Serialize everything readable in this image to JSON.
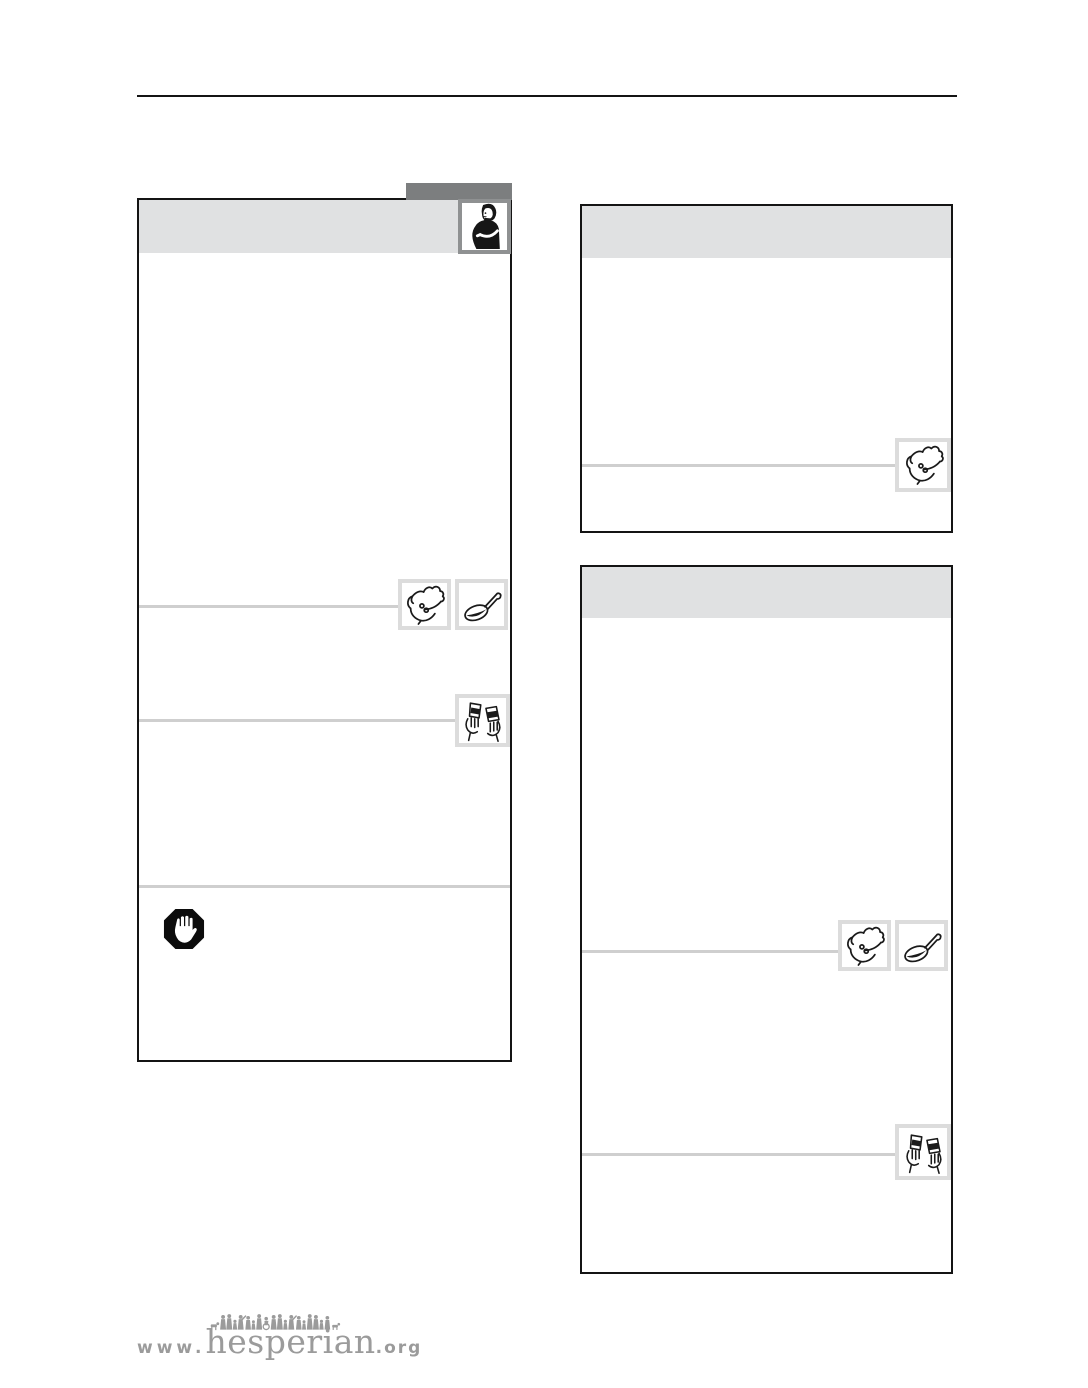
{
  "colors": {
    "ink": "#141414",
    "card_border": "#141414",
    "header_band": "#e0e1e2",
    "tab_gray": "#7c7e7f",
    "portrait_border": "#8f9192",
    "icon_frame": "#dcdcdc",
    "divider": "#cfcfcf",
    "logo_gray": "#9b9b9b",
    "paper": "#ffffff"
  },
  "footer": {
    "www": "www.",
    "name": "hesperian",
    "tld": ".org"
  },
  "icons": {
    "pregnant-woman-icon": "line drawing of a pregnant woman in dark top, hand on belly",
    "hand-with-pills-icon": "open hand holding two pills",
    "spoon-icon": "spoon filled with dark liquid medicine",
    "hands-with-cups-icon": "two hands holding small medicine cups",
    "stop-hand-icon": "black octagon with white raised hand (stop/warning)",
    "people-figures-icon": "row of small walking people silhouettes above logo text"
  }
}
